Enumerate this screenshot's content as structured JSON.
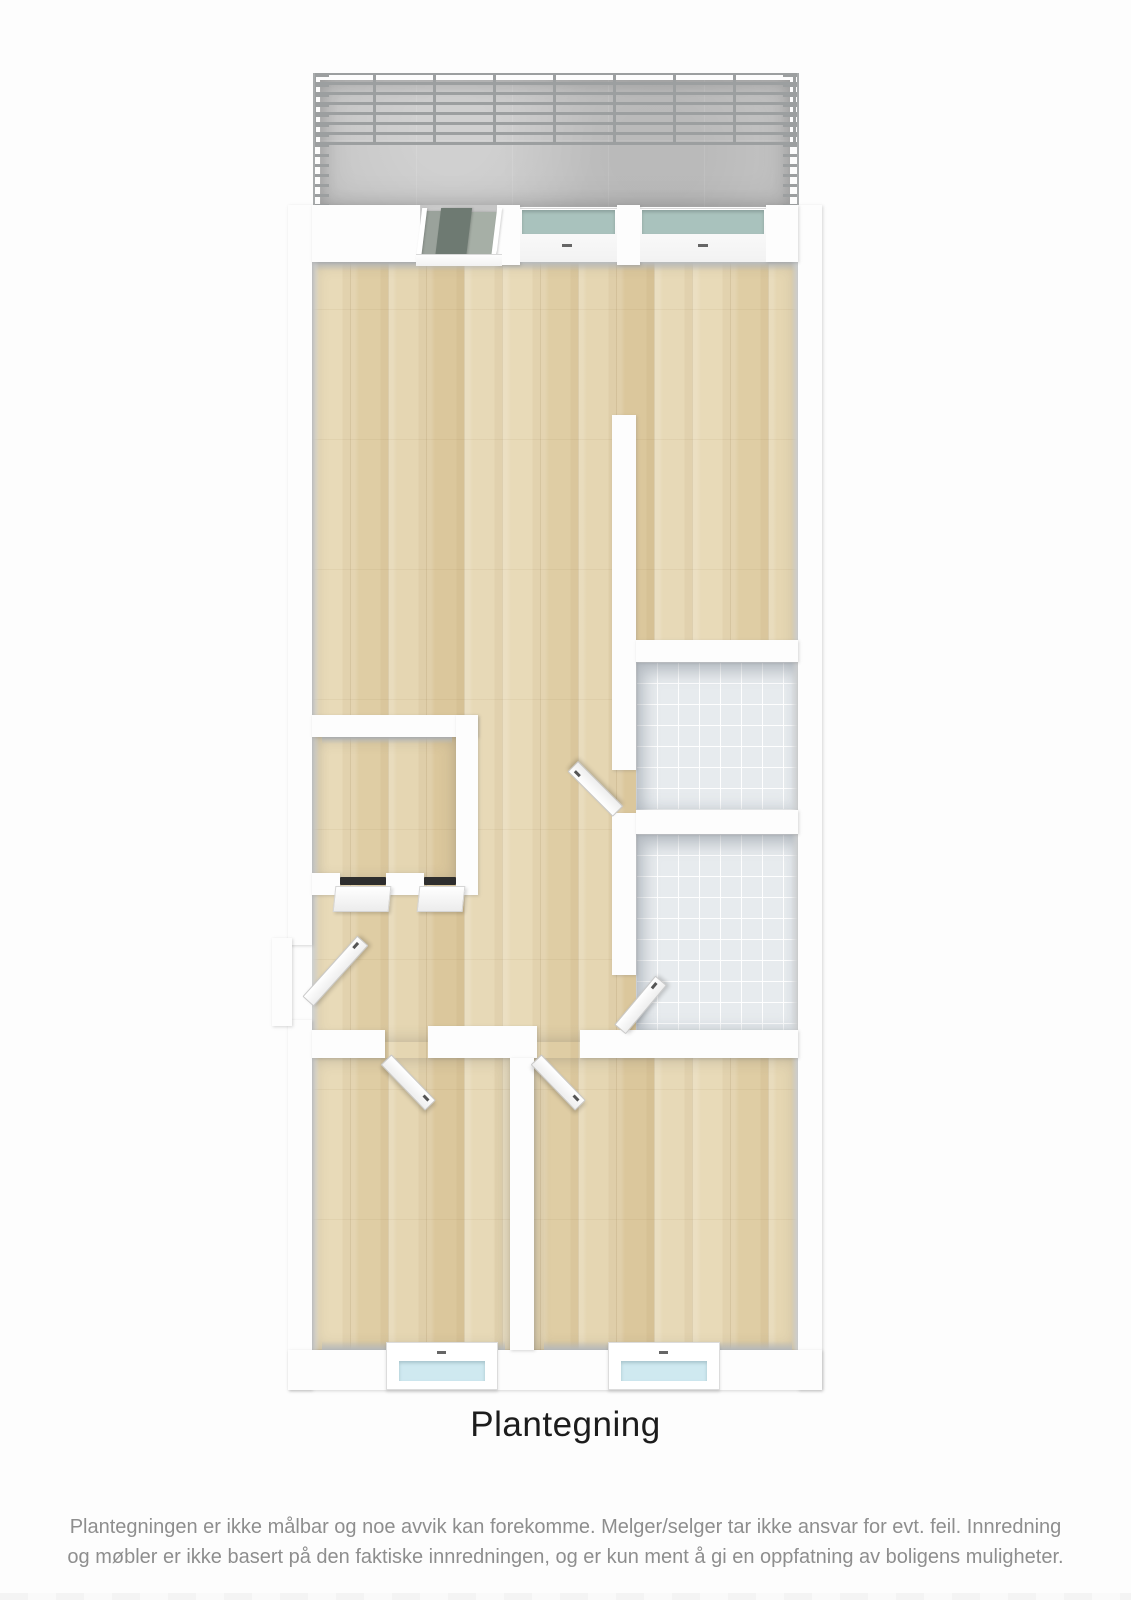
{
  "title": "Plantegning",
  "disclaimer": [
    "Plantegningen er ikke målbar og noe avvik kan forekomme. Melger/selger tar ikke ansvar for evt. feil. Innredning",
    "og møbler er ikke basert på den faktiske innredningen, og er kun ment å gi en oppfatning av boligens muligheter."
  ],
  "colors": {
    "wall": "#fdfdfd",
    "wood_floor": "#e4d4b0",
    "tile_floor": "#e7ebee",
    "concrete": "#c6c6c6",
    "railing": "#9c9fa0",
    "window_glass_teal": "#a9c2bd",
    "window_glass_blue": "#cfe9f0",
    "door_glass_dark": "#6e7a72",
    "door_glass_light": "#9aa29b",
    "title_text": "#1c1c1c",
    "disclaimer_text": "#8e8e8e"
  }
}
